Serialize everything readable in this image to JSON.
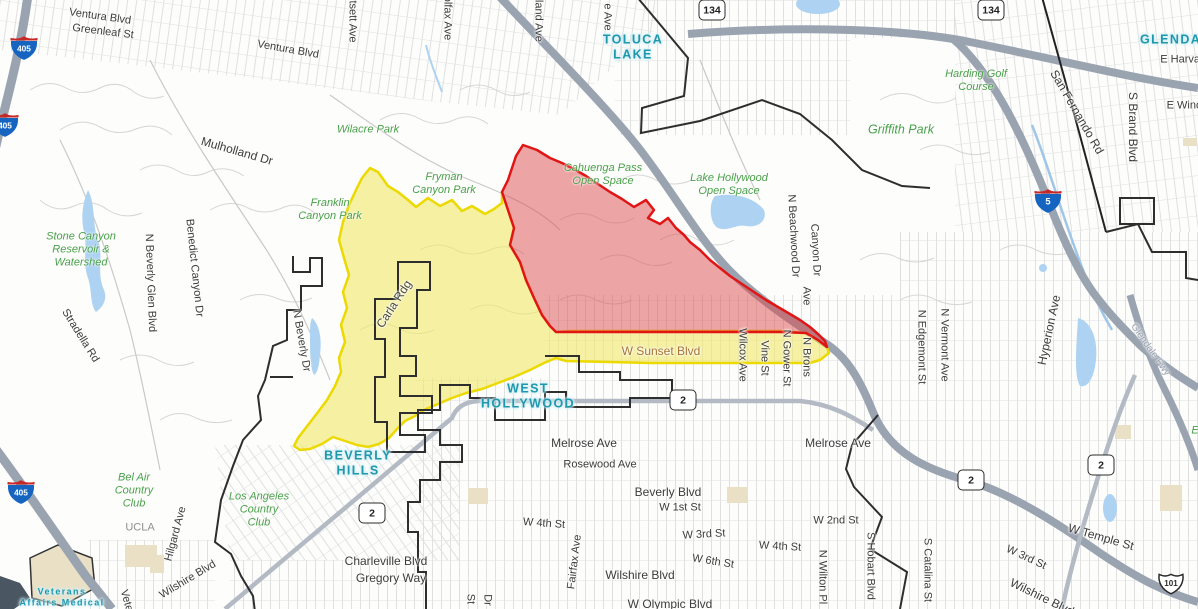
{
  "map_type": "evacuation-zones-street-map",
  "colors": {
    "road": "#3c3c3c",
    "park": "#4aa04a",
    "city": "#1f98ad",
    "sunset": "#a8742f",
    "ridge": "#4a4a40",
    "area": "#8f8f8f",
    "fwy": "#9aa3b0",
    "water": "#aed3f2",
    "freeway": "#9aa3b0",
    "highway": "#b3bac4",
    "boundary": "#2e2e2e",
    "campus": "#e9e0c6"
  },
  "zones": [
    {
      "id": "warning",
      "name": "evacuation-warning-zone",
      "fill": "#f0e96a",
      "fill_opacity": 0.62,
      "stroke": "#ecd900"
    },
    {
      "id": "order",
      "name": "evacuation-order-zone",
      "fill": "#dd4b4b",
      "fill_opacity": 0.5,
      "stroke": "#e01616"
    }
  ],
  "city_labels": [
    {
      "lines": [
        "TOLUCA",
        "LAKE"
      ],
      "x": 633,
      "y": 47
    },
    {
      "lines": [
        "GLENDALE"
      ],
      "x": 1180,
      "y": 40
    },
    {
      "lines": [
        "WEST",
        "HOLLYWOOD"
      ],
      "x": 528,
      "y": 396
    },
    {
      "lines": [
        "BEVERLY",
        "HILLS"
      ],
      "x": 358,
      "y": 463
    },
    {
      "lines": [
        "Veterans",
        "Affairs Medical"
      ],
      "x": 62,
      "y": 597,
      "size": 9
    }
  ],
  "park_labels": [
    {
      "lines": [
        "Wilacre Park"
      ],
      "x": 368,
      "y": 130
    },
    {
      "lines": [
        "Fryman",
        "Canyon Park"
      ],
      "x": 444,
      "y": 184
    },
    {
      "lines": [
        "Franklin",
        "Canyon Park"
      ],
      "x": 330,
      "y": 210
    },
    {
      "lines": [
        "Stone Canyon",
        "Reservoir &",
        "Watershed"
      ],
      "x": 81,
      "y": 250
    },
    {
      "lines": [
        "Cahuenga Pass",
        "Open Space"
      ],
      "x": 603,
      "y": 175
    },
    {
      "lines": [
        "Lake Hollywood",
        "Open Space"
      ],
      "x": 729,
      "y": 185
    },
    {
      "lines": [
        "Harding Golf",
        "Course"
      ],
      "x": 976,
      "y": 81
    },
    {
      "lines": [
        "Griffith Park"
      ],
      "x": 901,
      "y": 130,
      "size": 12.5
    },
    {
      "lines": [
        "Los Angeles",
        "Country",
        "Club"
      ],
      "x": 259,
      "y": 510
    },
    {
      "lines": [
        "Bel Air",
        "Country",
        "Club"
      ],
      "x": 134,
      "y": 491
    },
    {
      "lines": [
        "Elysian Park"
      ],
      "x": 1222,
      "y": 431
    }
  ],
  "road_labels": [
    {
      "t": "Ventura Blvd",
      "x": 100,
      "y": 17,
      "r": 8
    },
    {
      "t": "Greenleaf St",
      "x": 103,
      "y": 32,
      "r": 7
    },
    {
      "t": "Ventura Blvd",
      "x": 288,
      "y": 50,
      "r": 10
    },
    {
      "t": "Whitsett Ave",
      "x": 352,
      "y": 12,
      "r": 90
    },
    {
      "t": "Colfax Ave",
      "x": 447,
      "y": 14,
      "r": 90
    },
    {
      "t": "Vineland Ave",
      "x": 538,
      "y": 10,
      "r": 90
    },
    {
      "t": "e Ave",
      "x": 607,
      "y": 17,
      "r": 90
    },
    {
      "t": "Mulholland Dr",
      "x": 237,
      "y": 151,
      "r": 16,
      "s": 12
    },
    {
      "t": "Stradella Rd",
      "x": 80,
      "y": 336,
      "r": 58
    },
    {
      "t": "N Beverly Glen Blvd",
      "x": 150,
      "y": 283,
      "r": 88
    },
    {
      "t": "Benedict Canyon Dr",
      "x": 194,
      "y": 268,
      "r": 84
    },
    {
      "t": "N Beverly Dr",
      "x": 301,
      "y": 341,
      "r": 80
    },
    {
      "t": "Carla Rdg",
      "x": 394,
      "y": 304,
      "r": -57,
      "c": "ridge",
      "s": 12
    },
    {
      "t": "Hilgard Ave",
      "x": 176,
      "y": 534,
      "r": -75
    },
    {
      "t": "Wilshire Blvd",
      "x": 188,
      "y": 580,
      "r": -31
    },
    {
      "t": "Veterans",
      "x": 129,
      "y": 611,
      "r": 74
    },
    {
      "t": "W Sunset Blvd",
      "x": 661,
      "y": 351,
      "r": 0,
      "c": "sunset",
      "s": 12
    },
    {
      "t": "Wilcox Ave",
      "x": 742,
      "y": 355,
      "r": 90
    },
    {
      "t": "Vine St",
      "x": 764,
      "y": 358,
      "r": 90
    },
    {
      "t": "N Gower St",
      "x": 786,
      "y": 358,
      "r": 90
    },
    {
      "t": "Ave",
      "x": 806,
      "y": 296,
      "r": 90
    },
    {
      "t": "N Brons",
      "x": 806,
      "y": 357,
      "r": 90
    },
    {
      "t": "N Beachwood Dr",
      "x": 793,
      "y": 236,
      "r": 87
    },
    {
      "t": "Canyon Dr",
      "x": 815,
      "y": 250,
      "r": 87
    },
    {
      "t": "N Vermont Ave",
      "x": 944,
      "y": 345,
      "r": 90
    },
    {
      "t": "N Edgemont St",
      "x": 921,
      "y": 347,
      "r": 90
    },
    {
      "t": "Hyperion Ave",
      "x": 1049,
      "y": 330,
      "r": -78,
      "s": 12
    },
    {
      "t": "San Fernando Rd",
      "x": 1077,
      "y": 112,
      "r": 60,
      "s": 12
    },
    {
      "t": "S Brand Blvd",
      "x": 1133,
      "y": 127,
      "r": 90,
      "s": 12
    },
    {
      "t": "E Harvard",
      "x": 1185,
      "y": 60,
      "r": 0
    },
    {
      "t": "E Windsor",
      "x": 1192,
      "y": 106,
      "r": 0
    },
    {
      "t": "Melrose Ave",
      "x": 584,
      "y": 443,
      "s": 12
    },
    {
      "t": "Rosewood Ave",
      "x": 600,
      "y": 465
    },
    {
      "t": "Beverly Blvd",
      "x": 668,
      "y": 492,
      "s": 12
    },
    {
      "t": "W 1st St",
      "x": 680,
      "y": 508
    },
    {
      "t": "W 4th St",
      "x": 544,
      "y": 524,
      "r": 4
    },
    {
      "t": "W 3rd St",
      "x": 704,
      "y": 535,
      "r": -3
    },
    {
      "t": "Melrose Ave",
      "x": 838,
      "y": 443,
      "s": 12
    },
    {
      "t": "W 2nd St",
      "x": 836,
      "y": 521
    },
    {
      "t": "W 4th St",
      "x": 780,
      "y": 547,
      "r": 3
    },
    {
      "t": "W 6th St",
      "x": 713,
      "y": 562,
      "r": 9
    },
    {
      "t": "Wilshire Blvd",
      "x": 640,
      "y": 575,
      "s": 12
    },
    {
      "t": "W Olympic Blvd",
      "x": 670,
      "y": 604,
      "s": 12
    },
    {
      "t": "Fairfax Ave",
      "x": 575,
      "y": 562,
      "r": -83
    },
    {
      "t": "Charleville Blvd",
      "x": 386,
      "y": 561,
      "s": 12
    },
    {
      "t": "Gregory Way",
      "x": 391,
      "y": 578,
      "s": 12
    },
    {
      "t": "W Temple St",
      "x": 1101,
      "y": 537,
      "r": 16,
      "s": 12
    },
    {
      "t": "W 3rd St",
      "x": 1026,
      "y": 558,
      "r": 25
    },
    {
      "t": "Wilshire Blvd",
      "x": 1042,
      "y": 597,
      "r": 26,
      "s": 12
    },
    {
      "t": "N Wilton Pl",
      "x": 822,
      "y": 577,
      "r": 90
    },
    {
      "t": "S Hobart Blvd",
      "x": 870,
      "y": 566,
      "r": 90
    },
    {
      "t": "S Catalina St",
      "x": 927,
      "y": 570,
      "r": 90
    },
    {
      "t": "St",
      "x": 470,
      "y": 599,
      "r": 90
    },
    {
      "t": "Dr",
      "x": 487,
      "y": 600,
      "r": 90
    },
    {
      "t": "UCLA",
      "x": 140,
      "y": 528,
      "c": "area"
    },
    {
      "t": "Glendale Fwy",
      "x": 1150,
      "y": 350,
      "r": 55,
      "c": "fwy",
      "s": 10
    }
  ],
  "shields": [
    {
      "type": "interstate",
      "num": "405",
      "x": 24,
      "y": 48
    },
    {
      "type": "interstate",
      "num": "405",
      "x": 5,
      "y": 125
    },
    {
      "type": "interstate",
      "num": "405",
      "x": 21,
      "y": 492
    },
    {
      "type": "interstate",
      "num": "5",
      "x": 1048,
      "y": 201
    },
    {
      "type": "state",
      "num": "134",
      "x": 712,
      "y": 10
    },
    {
      "type": "state",
      "num": "134",
      "x": 991,
      "y": 10
    },
    {
      "type": "state",
      "num": "2",
      "x": 683,
      "y": 400
    },
    {
      "type": "state",
      "num": "2",
      "x": 372,
      "y": 513
    },
    {
      "type": "state",
      "num": "2",
      "x": 971,
      "y": 480
    },
    {
      "type": "state",
      "num": "2",
      "x": 1101,
      "y": 465
    },
    {
      "type": "us",
      "num": "101",
      "x": 1171,
      "y": 583
    }
  ]
}
